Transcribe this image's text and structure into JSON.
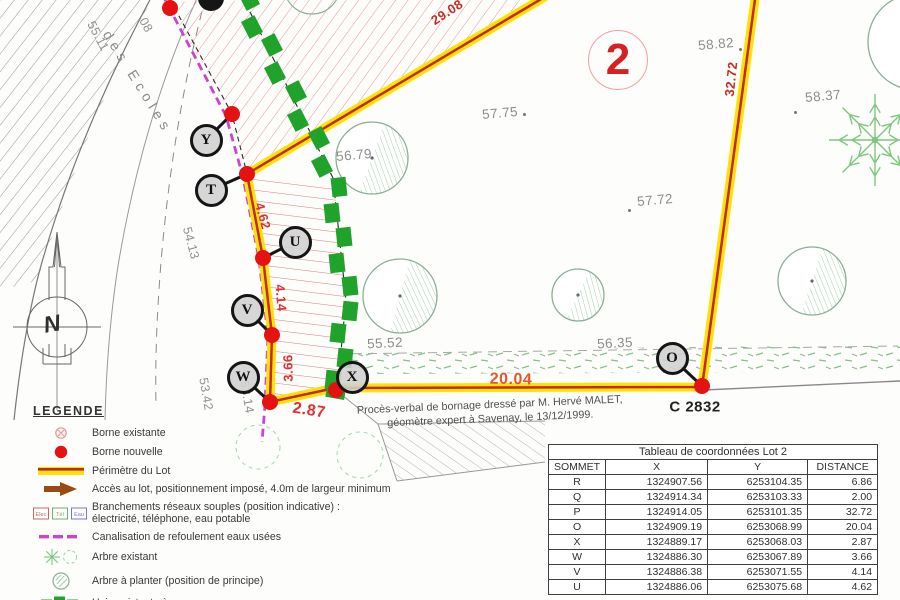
{
  "colors": {
    "perimeter_yellow": "#ffe205",
    "perimeter_red": "#c02a1a",
    "borne_red": "#e51212",
    "hedge_green": "#1fa32a",
    "canalisation_magenta": "#cf42cf",
    "distance_red": "#e03030",
    "lot_number_red": "#d42222",
    "tree_green": "#8fae96",
    "elevation_gray": "#8e8e8e"
  },
  "map": {
    "lot_number": "2",
    "parcel_ref": "C 2832",
    "compass": "N",
    "street": {
      "name": "des Ecoles"
    },
    "note_line1": "Procès-verbal de bornage dressé par M. Hervé MALET,",
    "note_line2": "géomètre expert à Savenay, le 13/12/1999.",
    "elevations": [
      {
        "t": "57.75",
        "x": 500,
        "y": 113,
        "r": -5
      },
      {
        "t": "56.79",
        "x": 354,
        "y": 155,
        "r": -5
      },
      {
        "t": "57.72",
        "x": 655,
        "y": 200,
        "r": -5
      },
      {
        "t": "58.82",
        "x": 716,
        "y": 44,
        "r": -5
      },
      {
        "t": "58.37",
        "x": 823,
        "y": 96,
        "r": -5
      },
      {
        "t": "55.52",
        "x": 385,
        "y": 343,
        "r": -3
      },
      {
        "t": "56.35",
        "x": 615,
        "y": 343,
        "r": -3
      }
    ],
    "level_dots": [
      [
        524,
        114
      ],
      [
        629,
        210
      ],
      [
        740,
        49
      ],
      [
        795,
        112
      ]
    ],
    "road_levels": [
      {
        "t": "08",
        "x": 146,
        "y": 25,
        "r": 62
      },
      {
        "t": "55.11",
        "x": 98,
        "y": 36,
        "r": 62
      },
      {
        "t": "54.13",
        "x": 191,
        "y": 243,
        "r": 75
      },
      {
        "t": "53.42",
        "x": 206,
        "y": 394,
        "r": 80
      },
      {
        "t": "53.14",
        "x": 247,
        "y": 397,
        "r": 80
      }
    ],
    "distances": [
      {
        "t": "29.08",
        "x": 447,
        "y": 12,
        "r": -33,
        "c": "#c22f22"
      },
      {
        "t": "32.72",
        "x": 731,
        "y": 79,
        "r": -84,
        "c": "#c22f22"
      },
      {
        "t": "4.62",
        "x": 263,
        "y": 216,
        "r": 74,
        "c": "#e03030"
      },
      {
        "t": "4.14",
        "x": 281,
        "y": 298,
        "r": 85,
        "c": "#e03030"
      },
      {
        "t": "3.66",
        "x": 288,
        "y": 368,
        "r": -91,
        "c": "#e03030"
      },
      {
        "t": "2.87",
        "x": 309,
        "y": 411,
        "r": 9,
        "c": "#e03030",
        "big": true
      },
      {
        "t": "20.04",
        "x": 511,
        "y": 380,
        "r": 1,
        "c": "#e8542e",
        "big": true
      }
    ],
    "vertices": [
      {
        "l": "Y",
        "cx": 206,
        "cy": 140,
        "dx": 232,
        "dy": 114
      },
      {
        "l": "T",
        "cx": 211,
        "cy": 190,
        "dx": 247,
        "dy": 174
      },
      {
        "l": "U",
        "cx": 295,
        "cy": 242,
        "dx": 263,
        "dy": 258
      },
      {
        "l": "V",
        "cx": 247,
        "cy": 310,
        "dx": 272,
        "dy": 335
      },
      {
        "l": "W",
        "cx": 243,
        "cy": 377,
        "dx": 270,
        "dy": 402
      },
      {
        "l": "X",
        "cx": 352,
        "cy": 377,
        "dx": 336,
        "dy": 390
      },
      {
        "l": "O",
        "cx": 672,
        "cy": 358,
        "dx": 702,
        "dy": 386
      }
    ],
    "extra_dots": [
      [
        170,
        8
      ]
    ]
  },
  "legend": {
    "title": "LEGENDE",
    "items": [
      {
        "icon": "borne-existante",
        "text": "Borne existante"
      },
      {
        "icon": "borne-nouvelle",
        "text": "Borne nouvelle"
      },
      {
        "icon": "perimetre",
        "text": "Périmètre du Lot"
      },
      {
        "icon": "acces",
        "text": "Accès au lot, positionnement imposé, 4.0m de largeur minimum"
      },
      {
        "icon": "branchements",
        "text": "Branchements réseaux souples (position indicative) :",
        "text2": "électricité, téléphone, eau potable",
        "boxes": [
          "Elec",
          "Tél",
          "Eau"
        ]
      },
      {
        "icon": "canalisation",
        "text": "Canalisation de refoulement eaux usées"
      },
      {
        "icon": "arbre-existant",
        "text": "Arbre existant"
      },
      {
        "icon": "arbre-planter",
        "text": "Arbre à planter (position de principe)"
      },
      {
        "icon": "haie",
        "text": "Haie existante à conserver"
      }
    ]
  },
  "table": {
    "title": "Tableau de coordonnées Lot 2",
    "headers": [
      "SOMMET",
      "X",
      "Y",
      "DISTANCE"
    ],
    "rows": [
      [
        "R",
        "1324907.56",
        "6253104.35",
        "6.86"
      ],
      [
        "Q",
        "1324914.34",
        "6253103.33",
        "2.00"
      ],
      [
        "P",
        "1324914.05",
        "6253101.35",
        "32.72"
      ],
      [
        "O",
        "1324909.19",
        "6253068.99",
        "20.04"
      ],
      [
        "X",
        "1324889.17",
        "6253068.03",
        "2.87"
      ],
      [
        "W",
        "1324886.30",
        "6253067.89",
        "3.66"
      ],
      [
        "V",
        "1324886.38",
        "6253071.55",
        "4.14"
      ],
      [
        "U",
        "1324886.06",
        "6253075.68",
        "4.62"
      ]
    ]
  }
}
